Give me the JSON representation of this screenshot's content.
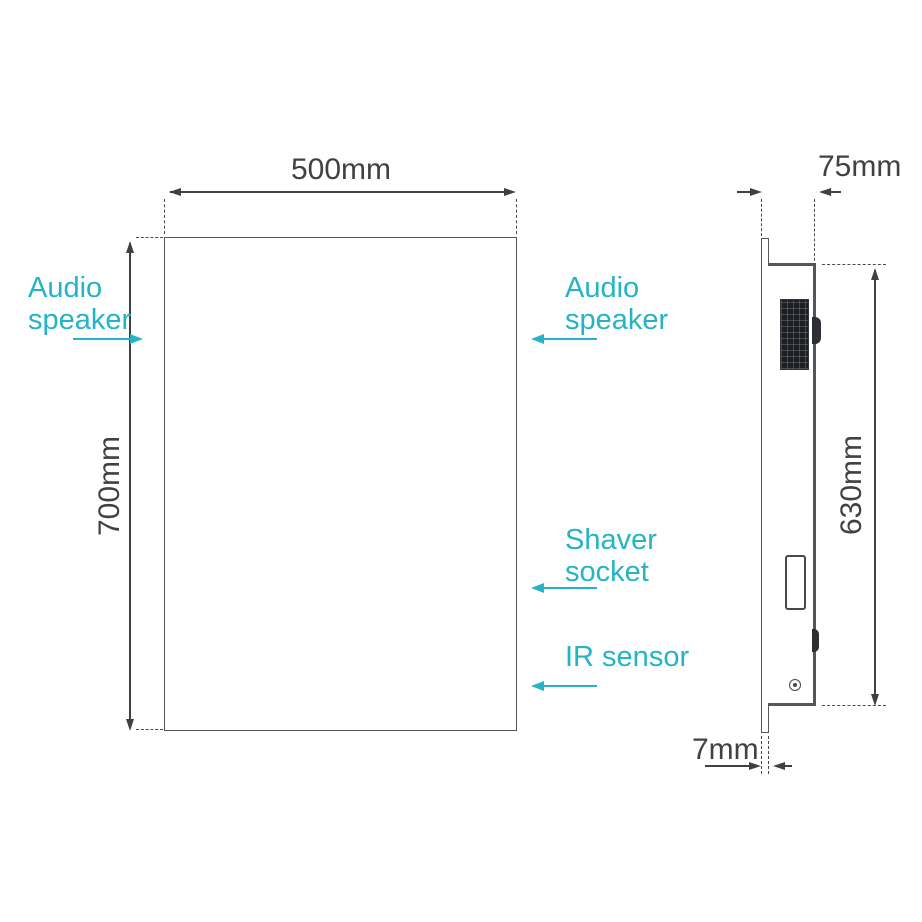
{
  "colors": {
    "accent": "#25b3c7",
    "line": "#3f4042",
    "outline": "#55565b"
  },
  "front_view": {
    "width_label": "500mm",
    "height_label": "700mm",
    "labels": {
      "audio_speaker_left": "Audio\nspeaker",
      "audio_speaker_right": "Audio\nspeaker",
      "shaver_socket": "Shaver\nsocket",
      "ir_sensor": "IR sensor"
    }
  },
  "side_view": {
    "depth_label": "75mm",
    "height_label": "630mm",
    "glass_thickness_label": "7mm"
  }
}
